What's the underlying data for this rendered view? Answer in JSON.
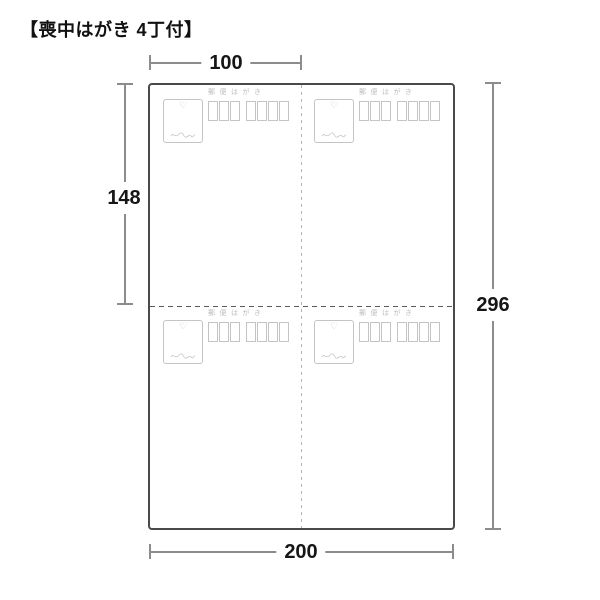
{
  "title": "【喪中はがき 4丁付】",
  "dimensions": {
    "card_width": "100",
    "card_height": "148",
    "sheet_height": "296",
    "sheet_width": "200"
  },
  "postcard": {
    "postal_label": "郵便はがき",
    "postal_code_boxes": 7,
    "postal_code_grouping": "3+4",
    "count": 4
  },
  "icons": {
    "heart": "♡"
  },
  "colors": {
    "sheet_border": "#4a4a4a",
    "dimension_line": "#8c8c8c",
    "label_text": "#161616",
    "card_detail": "#c4c4c4"
  }
}
